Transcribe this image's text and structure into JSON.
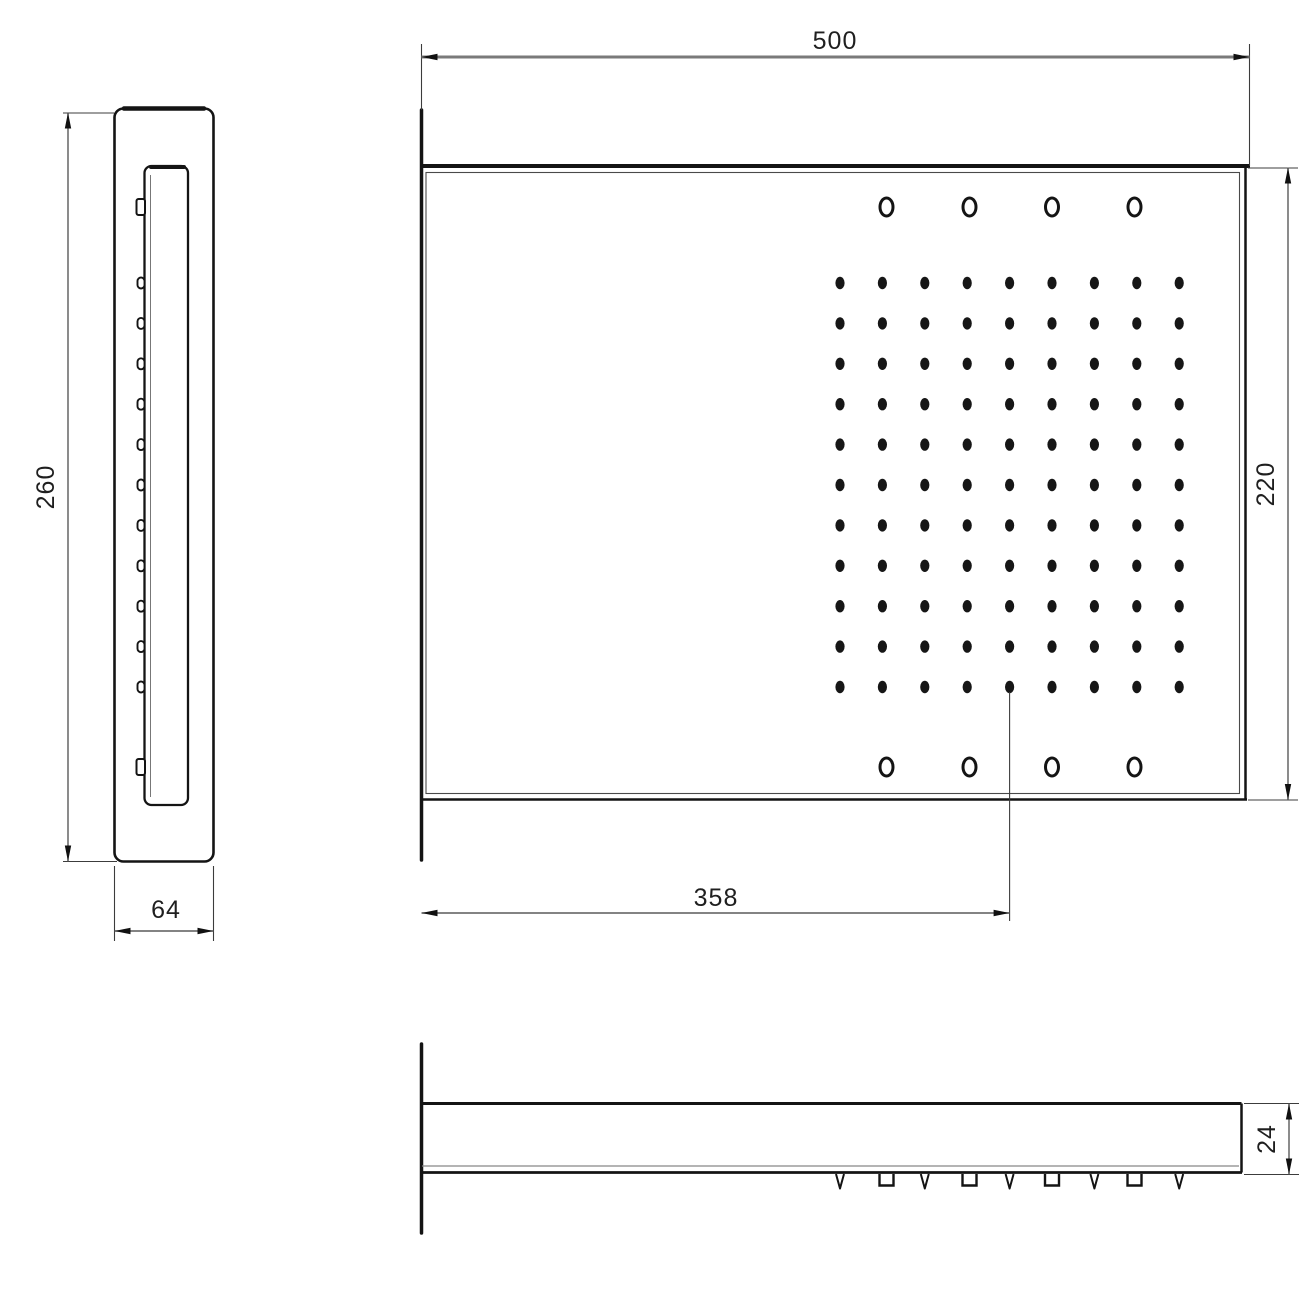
{
  "drawing": {
    "title": "rectangular shower head - three view technical drawing",
    "dimensions": {
      "front_width": "500",
      "front_height": "220",
      "grid_center_offset": "358",
      "side_height": "260",
      "side_width": "64",
      "bottom_thickness": "24"
    },
    "colors": {
      "outline": "#141414",
      "thin_line": "#4a4a4a",
      "dim_line": "#6e6e6e",
      "dim_line_heavy": "#7a7a7a",
      "arrow": "#111111",
      "background": "#ffffff"
    },
    "geometry": {
      "dot_grid": {
        "cols": 9,
        "rows": 11,
        "x0": 840.0,
        "y0": 283.0,
        "dx": 42.4,
        "dy": 40.4,
        "dot_rx": 4.6,
        "dot_ry": 6.2
      },
      "ring_holes": {
        "x": [
          886.5,
          969.5,
          1052.0,
          1134.5
        ],
        "rows_y": [
          207,
          767
        ],
        "rx": 6.5,
        "ry": 9.0,
        "stroke_w": 3
      },
      "side_bumps": {
        "edge_x": 144.5,
        "square_rows_y": [
          207,
          767
        ]
      },
      "bottom_bumps": {
        "v_x": [
          840.0,
          924.8,
          1009.6,
          1094.4,
          1179.2
        ],
        "square_x": [
          886.5,
          969.5,
          1052.0,
          1134.5
        ],
        "top_y": 1174
      }
    }
  }
}
